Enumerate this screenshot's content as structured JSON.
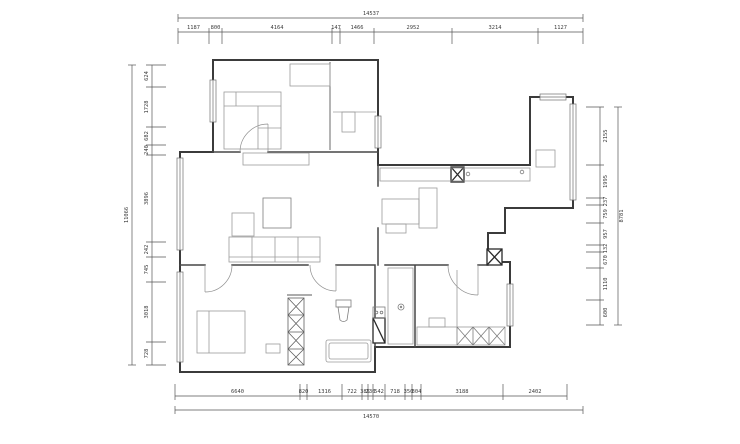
{
  "drawing": {
    "kind": "floor-plan",
    "ink_color": "#3b3b3b",
    "furniture_color": "#9b9b9b",
    "background": "#ffffff"
  },
  "dimensions": {
    "top": {
      "total": "14537",
      "segments": [
        "1187",
        "800",
        "4164",
        "147",
        "1466",
        "2952",
        "3214",
        "1127"
      ]
    },
    "bottom": {
      "total": "14570",
      "segments": [
        "6640",
        "820",
        "1316",
        "722",
        "385",
        "230",
        "542",
        "718",
        "350",
        "304",
        "3188",
        "2402"
      ]
    },
    "left": {
      "total": "11066",
      "segments": [
        "624",
        "1728",
        "682",
        "240",
        "3896",
        "242",
        "745",
        "3018",
        "728"
      ]
    },
    "right": {
      "total": "8781",
      "segments": [
        "2155",
        "1995",
        "237",
        "759",
        "957",
        "132",
        "670",
        "1110",
        "600"
      ]
    }
  }
}
